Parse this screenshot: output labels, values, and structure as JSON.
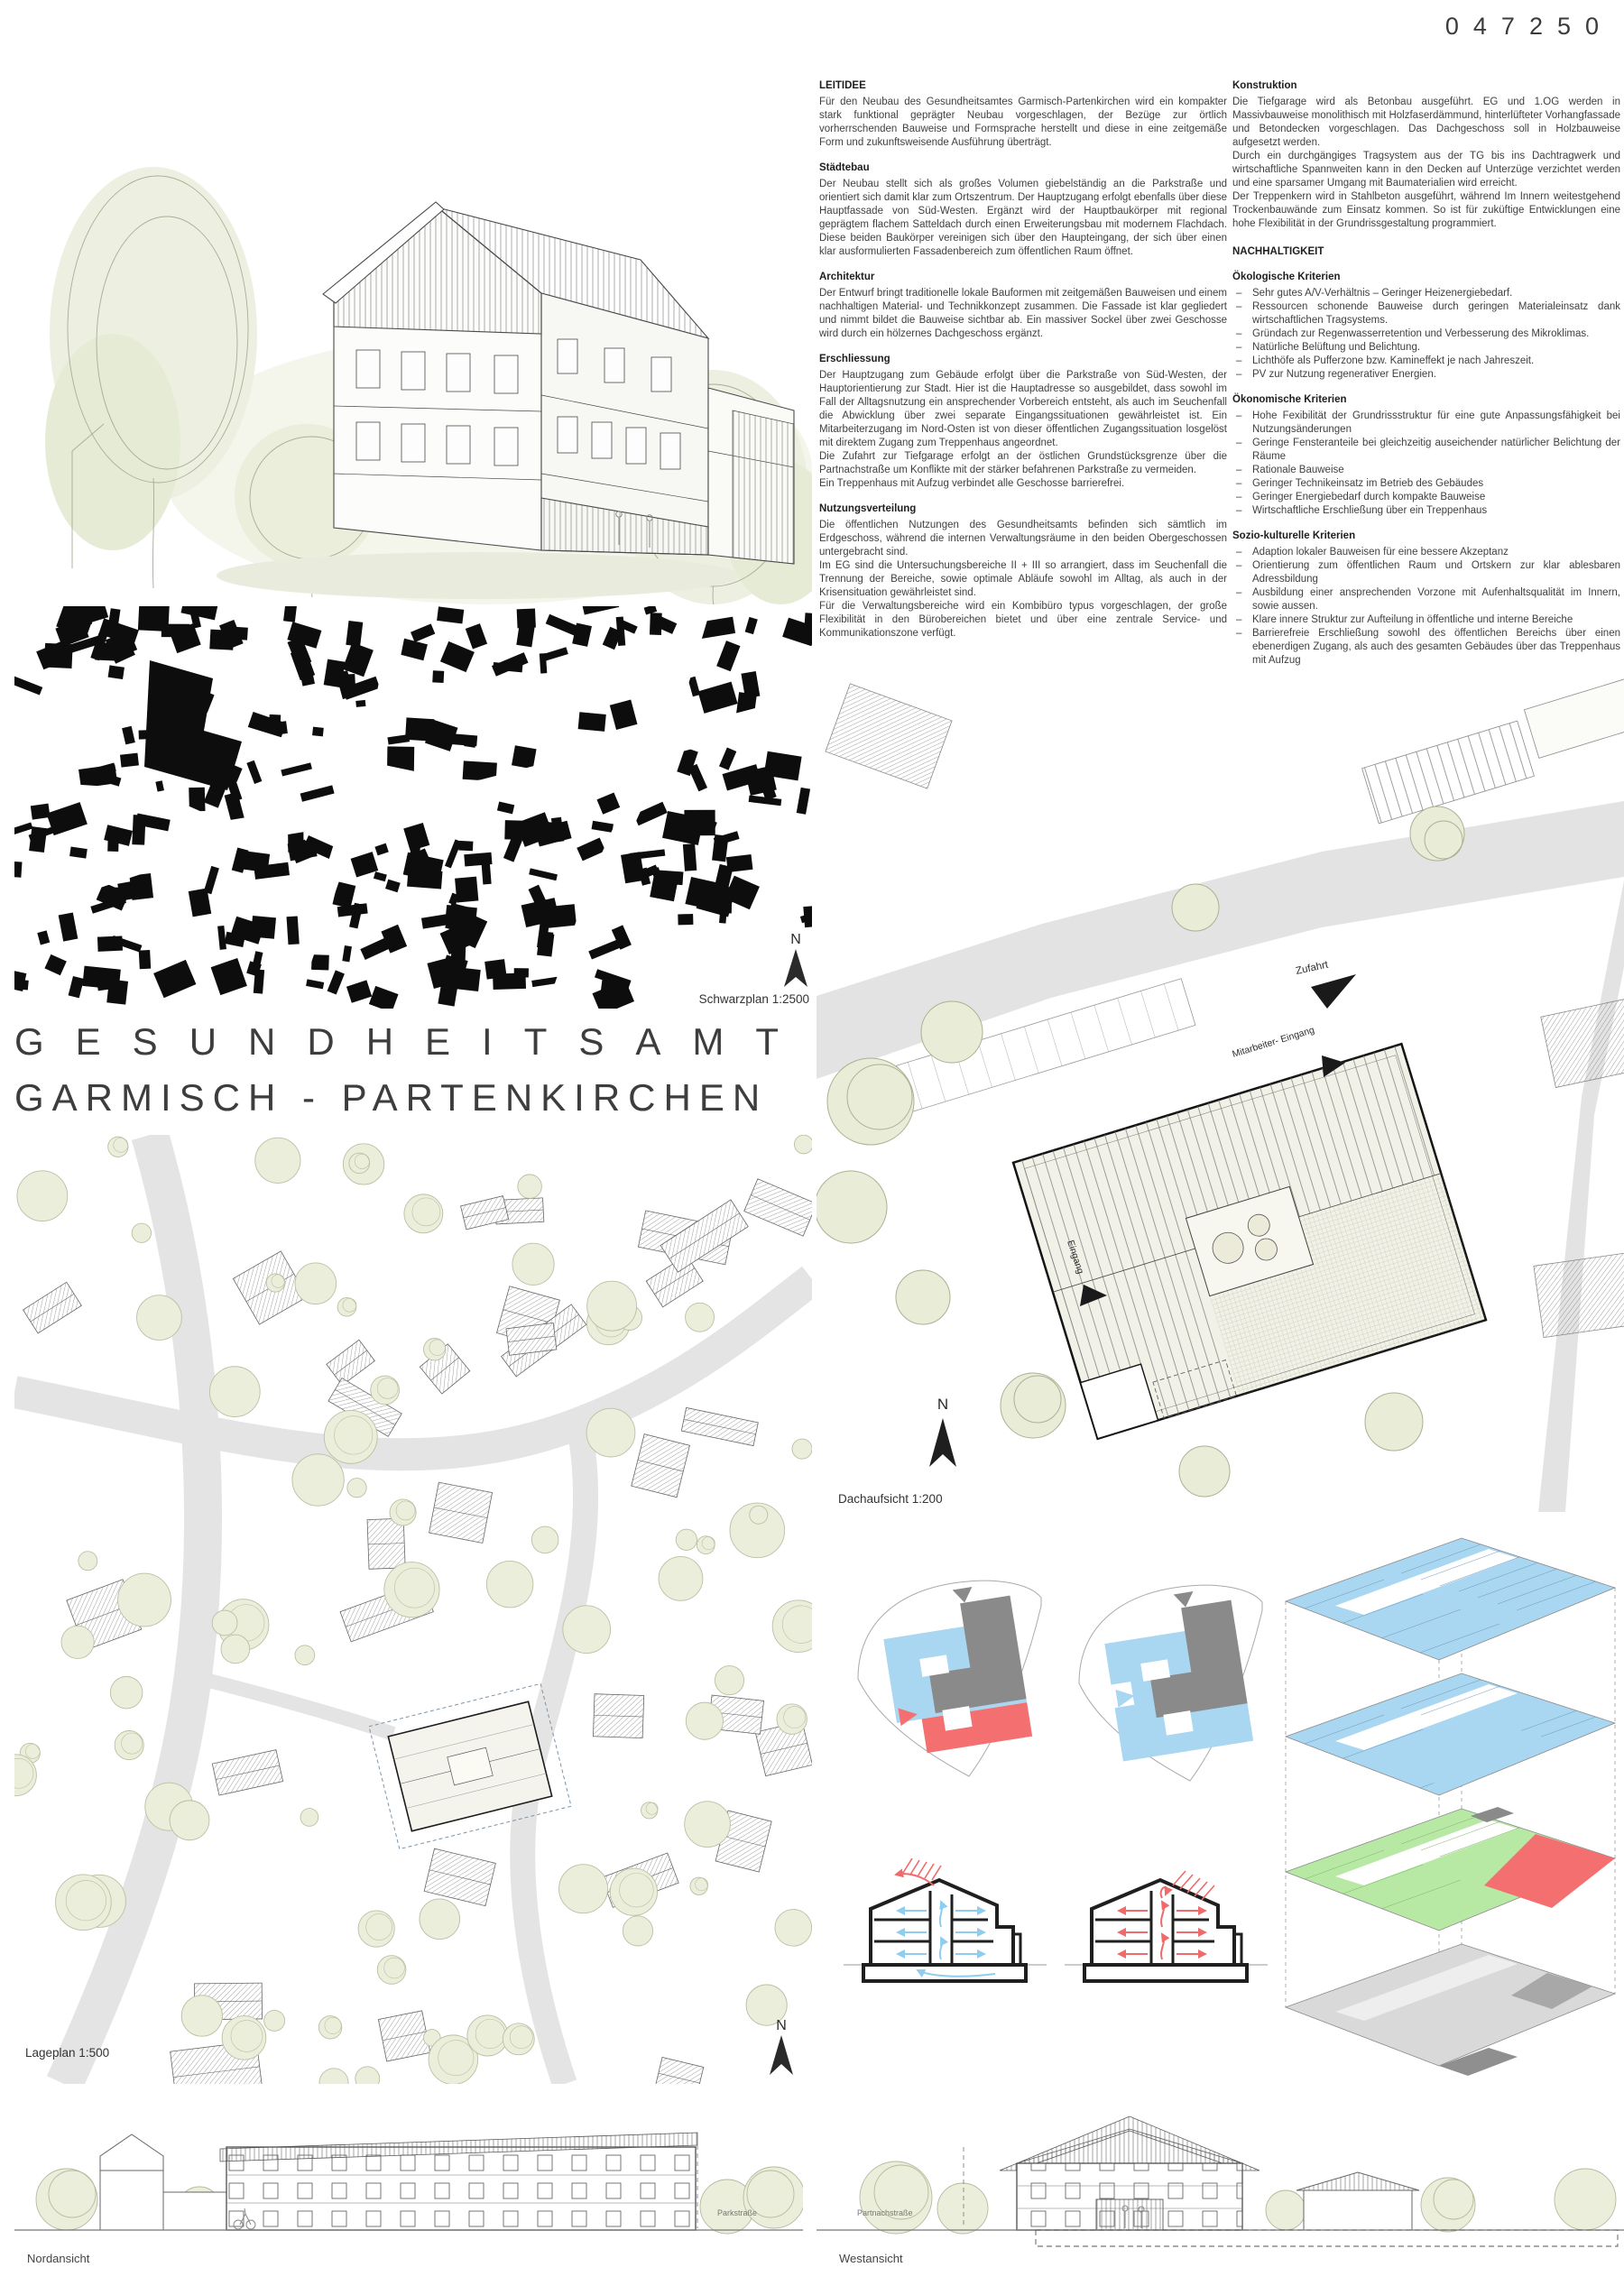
{
  "board": {
    "entry_number": "047250",
    "title_line1": "GESUNDHEITSAMT",
    "title_line2": "GARMISCH - PARTENKIRCHEN"
  },
  "captions": {
    "schwarzplan": "Schwarzplan 1:2500",
    "lageplan": "Lageplan 1:500",
    "dachaufsicht": "Dachaufsicht 1:200",
    "nordansicht": "Nordansicht",
    "westansicht": "Westansicht",
    "north": "N"
  },
  "plan_labels": {
    "zufahrt": "Zufahrt",
    "mitarbeiter_eingang": "Mitarbeiter- Eingang",
    "eingang": "Eingang",
    "parkstrasse": "Parkstraße",
    "partnachstrasse": "Partnachstraße"
  },
  "col1": {
    "s0": {
      "h": "LEITIDEE",
      "p0": "Für den Neubau des Gesundheitsamtes Garmisch-Partenkirchen wird ein kompakter stark funktional geprägter Neubau vorgeschlagen, der Bezüge zur örtlich vorherrschenden Bauweise und Formsprache herstellt und diese in eine zeitgemäße Form und zukunftsweisende Ausführung überträgt."
    },
    "s1": {
      "h": "Städtebau",
      "p0": "Der Neubau stellt sich als großes Volumen giebelständig an die Parkstraße und orientiert sich damit klar zum Ortszentrum. Der Hauptzugang erfolgt ebenfalls über diese Hauptfassade von Süd-Westen. Ergänzt wird der Hauptbaukörper mit regional geprägtem flachem Satteldach durch einen Erweiterungsbau mit modernem Flachdach. Diese beiden Baukörper vereinigen sich über den Haupteingang, der sich über einen klar ausformulierten Fassadenbereich zum öffentlichen Raum öffnet."
    },
    "s2": {
      "h": "Architektur",
      "p0": "Der Entwurf bringt traditionelle lokale Bauformen mit zeitgemäßen Bauweisen und einem nachhaltigen Material- und Technikkonzept zusammen. Die Fassade ist klar gegliedert und nimmt bildet die Bauweise sichtbar ab. Ein massiver Sockel über zwei Geschosse wird durch ein hölzernes Dachgeschoss ergänzt."
    },
    "s3": {
      "h": "Erschliessung",
      "p0": "Der Hauptzugang zum Gebäude erfolgt über die Parkstraße von Süd-Westen, der Hauptorientierung zur Stadt. Hier ist die Hauptadresse so ausgebildet, dass sowohl im Fall der Alltagsnutzung ein ansprechender Vorbereich entsteht, als auch im Seuchenfall die Abwicklung über zwei separate Eingangssituationen gewährleistet ist. Ein Mitarbeiterzugang im Nord-Osten ist von dieser öffentlichen Zugangssituation losgelöst mit direktem Zugang zum Treppenhaus angeordnet.",
      "p1": "Die Zufahrt zur Tiefgarage erfolgt an der östlichen Grundstücksgrenze über die Partnachstraße um Konflikte mit der stärker befahrenen Parkstraße zu vermeiden.",
      "p2": "Ein Treppenhaus mit Aufzug verbindet alle Geschosse barrierefrei."
    },
    "s4": {
      "h": "Nutzungsverteilung",
      "p0": "Die öffentlichen Nutzungen des Gesundheitsamts befinden sich sämtlich im Erdgeschoss, während die internen Verwaltungsräume in den beiden Obergeschossen untergebracht sind.",
      "p1": "Im EG sind die Untersuchungsbereiche II + III so arrangiert, dass im Seuchenfall die Trennung der Bereiche, sowie optimale Abläufe sowohl im Alltag, als auch in der Krisensituation gewährleistet sind.",
      "p2": "Für die Verwaltungsbereiche wird ein Kombibüro typus vorgeschlagen, der große Flexibilität in den Bürobereichen bietet und über eine zentrale Service- und Kommunikationszone verfügt."
    }
  },
  "col2": {
    "s0": {
      "h": "Konstruktion",
      "p0": "Die Tiefgarage wird als Betonbau ausgeführt. EG und 1.OG werden in Massivbauweise monolithisch mit Holzfaserdämmund, hinterlüfteter Vorhangfassade und Betondecken vorgeschlagen. Das Dachgeschoss soll in Holzbauweise aufgesetzt werden.",
      "p1": "Durch ein durchgängiges Tragsystem aus der TG bis ins Dachtragwerk und wirtschaftliche Spannweiten kann in den Decken auf Unterzüge verzichtet werden und eine sparsamer Umgang mit Baumaterialien wird erreicht.",
      "p2": "Der Treppenkern wird in Stahlbeton ausgeführt, während Im Innern weitestgehend Trockenbauwände zum Einsatz kommen. So ist für zuküftige Entwicklungen eine hohe Flexibilität in der Grundrissgestaltung programmiert."
    },
    "nach_h": "NACHHALTIGKEIT",
    "eco": {
      "h": "Ökologische Kriterien",
      "b0": "Sehr gutes A/V-Verhältnis – Geringer Heizenergiebedarf.",
      "b1": "Ressourcen schonende Bauweise durch geringen Materialeinsatz dank wirtschaftlichen Tragsystems.",
      "b2": "Gründach zur Regenwasserretention und Verbesserung des Mikroklimas.",
      "b3": "Natürliche Belüftung und Belichtung.",
      "b4": "Lichthöfe als Pufferzone bzw. Kamineffekt je nach Jahreszeit.",
      "b5": "PV zur Nutzung regenerativer Energien."
    },
    "econ": {
      "h": "Ökonomische Kriterien",
      "b0": "Hohe Fexibilität der Grundrissstruktur für eine gute Anpassungsfähigkeit bei Nutzungsänderungen",
      "b1": "Geringe Fensteranteile bei gleichzeitig auseichender natürlicher Belichtung der Räume",
      "b2": "Rationale Bauweise",
      "b3": "Geringer Technikeinsatz im Betrieb des Gebäudes",
      "b4": "Geringer Energiebedarf durch kompakte Bauweise",
      "b5": "Wirtschaftliche Erschließung über ein Treppenhaus"
    },
    "socio": {
      "h": "Sozio-kulturelle Kriterien",
      "b0": "Adaption lokaler Bauweisen für eine bessere Akzeptanz",
      "b1": "Orientierung zum öffentlichen Raum und Ortskern zur klar ablesbaren Adressbildung",
      "b2": "Ausbildung einer ansprechenden Vorzone mit Aufenhaltsqualität im Innern, sowie aussen.",
      "b3": "Klare innere Struktur zur Aufteilung in öffentliche und interne Bereiche",
      "b4": "Barrierefreie Erschließung sowohl des öffentlichen Bereichs über einen ebenerdigen Zugang, als auch des gesamten Gebäudes über das Treppenhaus mit Aufzug"
    }
  },
  "colors": {
    "accent_blue": "#a9d6f1",
    "accent_red": "#f47070",
    "accent_green": "#b7e9a4",
    "tree_green": "#e9edd8",
    "road_gray": "#e3e3e3",
    "figure_black": "#0d0d0d"
  }
}
